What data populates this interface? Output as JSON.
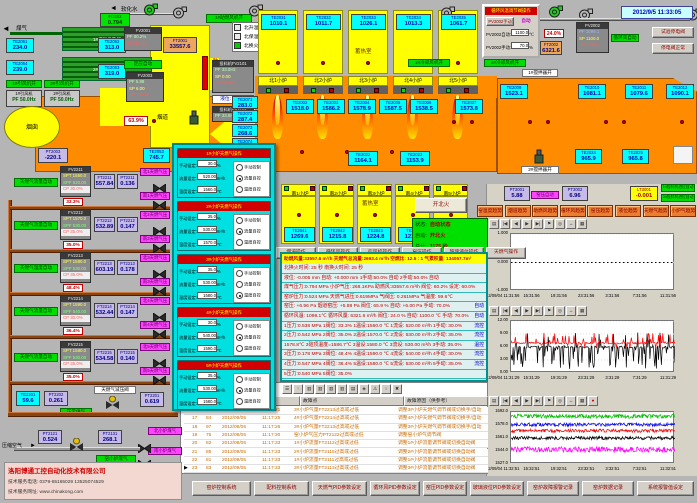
{
  "datetime": "2012/9/5 11:33:05",
  "top_left": {
    "gas_label": "煤气",
    "water_label": "软化水",
    "fi2202": {
      "tag": "FI2202",
      "value": "0.794"
    },
    "hx1": "1#煤气换热器",
    "hx2": "2#煤气换热器",
    "te2061": {
      "tag": "TE2061",
      "value": "234.0"
    },
    "te2062": {
      "tag": "TE2062",
      "value": "313.0"
    },
    "te2063": {
      "tag": "TE2063",
      "value": "319.0"
    },
    "te2064": {
      "tag": "TE2064",
      "value": "239.0"
    },
    "fan1_on": "1#引风机开",
    "fan2_on": "2#引风机开",
    "fan1": {
      "name": "1#引风机",
      "pf": "PF 50.0Hz"
    },
    "fan2": {
      "name": "2#引风机",
      "pf": "PF 50.0Hz"
    },
    "chimney": "烟囱",
    "flue": "烟道",
    "fv2001": {
      "tag": "FV2001",
      "pf": "PF 80.2%",
      "cp": "CP 80.1%"
    },
    "press_auto": "定压自动",
    "fv2003": {
      "tag": "FV2003",
      "pf": "PF 5.88",
      "sp": "SP 6.00",
      "cp": "CP 78.0%"
    },
    "ft2001": {
      "tag": "FT2001",
      "value": "33557.6"
    },
    "pt2003": {
      "tag": "PT2003",
      "value": "-220.1"
    },
    "te2053": {
      "tag": "TE2053",
      "value": "745.7"
    },
    "damper_pos": "63.9%",
    "blower_on": "1#助燃风机开",
    "damper_label": "助燃风开",
    "modes": [
      {
        "label": "北升温",
        "on": false
      },
      {
        "label": "北保温",
        "on": false
      },
      {
        "label": "北换火",
        "on": true
      }
    ],
    "feeder1": {
      "name": "投料机FV2101",
      "pf": "PF 33.0Hz",
      "sp": "SP 0.00",
      "cp": "CP 50.0%"
    },
    "level": "液位: -0.005",
    "feeder2": {
      "name": "投料机FV2102",
      "pf": "PF 33.9Hz"
    }
  },
  "north": {
    "regen": [
      {
        "tag": "TE2031",
        "value": "1010.1"
      },
      {
        "tag": "TE2032",
        "value": "1011.7"
      },
      {
        "tag": "TE2033",
        "value": "1026.1"
      },
      {
        "tag": "TE2034",
        "value": "1013.3"
      },
      {
        "tag": "TE2035",
        "value": "1061.7"
      }
    ],
    "regen_label": "蓄热室",
    "ports": [
      "北1小炉",
      "北2小炉",
      "北3小炉",
      "北4小炉",
      "北5小炉"
    ],
    "cooler1_on": "1#冷却风机开",
    "cooler2_on": "2#冷却风机开",
    "stir1_on": "1#搅拌器开",
    "stir2_on": "2#搅拌器开",
    "crown": [
      {
        "tag": "TE2002",
        "value": "1518.0"
      },
      {
        "tag": "TE2003",
        "value": "1586.2"
      },
      {
        "tag": "TE2004",
        "value": "1578.9"
      },
      {
        "tag": "TE2005",
        "value": "1587.5"
      },
      {
        "tag": "TE2006",
        "value": "1538.5"
      },
      {
        "tag": "TE2007",
        "value": "1573.8"
      }
    ],
    "te2009": {
      "tag": "TE2009",
      "value": "1523.1"
    },
    "side": [
      {
        "tag": "TE2071",
        "value": "283.0"
      },
      {
        "tag": "TE2072",
        "value": "287.4"
      },
      {
        "tag": "TE2073",
        "value": "268.6"
      },
      {
        "tag": "TE2074",
        "value": "269.6"
      }
    ],
    "neck": [
      {
        "tag": "TE2010",
        "value": "1081.1"
      },
      {
        "tag": "TE2011",
        "value": "1079.6"
      },
      {
        "tag": "TE2012",
        "value": "1090.1"
      }
    ],
    "waist": [
      {
        "tag": "TE2022",
        "value": "1164.1"
      },
      {
        "tag": "TE2023",
        "value": "1153.9"
      }
    ],
    "end": [
      {
        "tag": "TE2024",
        "value": "965.9"
      },
      {
        "tag": "TE2025",
        "value": "965.8"
      }
    ]
  },
  "south": {
    "ports": [
      "南1小炉",
      "南2小炉",
      "南3小炉",
      "南4小炉",
      "南5小炉"
    ],
    "regen_label": "蓄热室",
    "temps": [
      {
        "tag": "TE2041",
        "value": "1269.6"
      },
      {
        "tag": "TE2042",
        "value": "1215.8"
      },
      {
        "tag": "TE2043",
        "value": "1224.8"
      },
      {
        "tag": "TE2044",
        "value": "1212.6"
      },
      {
        "tag": "TE2045",
        "value": "1211.8"
      }
    ]
  },
  "fire_btn": "开北火",
  "status_box": {
    "rows": [
      [
        "状态:",
        "自动状态"
      ],
      [
        "自动:",
        "开北火"
      ],
      [
        "总计:",
        "1175 秒"
      ],
      [
        "计时:",
        "269 秒"
      ]
    ]
  },
  "op_buttons": [
    "烟道操作",
    "循环风操作",
    "引风机操作",
    "窑压操作",
    "玻璃液位操作",
    "天燃气操作"
  ],
  "fan_popup": {
    "title": "循环风温调节阀操作",
    "btn_manual": "PV2002手动",
    "mode": "自动",
    "row_auto": {
      "label": "PV2002自动:",
      "value": "1100.0",
      "unit": "℃"
    },
    "row_manual": {
      "label": "PV2002手动:",
      "value": "70.0",
      "unit": "%"
    }
  },
  "pv2002": {
    "tag": "PV2002",
    "pf": "PF 1098.1",
    "sp": "SP 1100.0",
    "cp": "CP 70.0%",
    "auto_label": "循环风自动",
    "pos": "24.0%",
    "ft": {
      "tag": "FT2002",
      "value": "6321.6"
    }
  },
  "tr_buttons": [
    "试验停电阀",
    "停电阀正常"
  ],
  "gas_popup": {
    "sections": [
      {
        "title": "1#小炉天燃气操作",
        "manual": "30.0",
        "flow": "520.00",
        "temp": "1560.0",
        "mode": 1
      },
      {
        "title": "2#小炉天燃气操作",
        "manual": "35.0",
        "flow": "530.00",
        "temp": "1570.0",
        "mode": 1
      },
      {
        "title": "3#小炉天燃气操作",
        "manual": "35.0",
        "flow": "530.00",
        "temp": "1580.0",
        "mode": 2
      },
      {
        "title": "4#小炉天燃气操作",
        "manual": "30.0",
        "flow": "540.00",
        "temp": "1590.0",
        "mode": 1
      },
      {
        "title": "5#小炉天燃气操作",
        "manual": "35.0",
        "flow": "530.00",
        "temp": "1580.0",
        "mode": 1
      }
    ],
    "field_labels": {
      "manual": "手动设定:",
      "flow": "流量设定:",
      "temp": "温度设定:"
    },
    "units": {
      "manual": "%",
      "flow": "m³/h",
      "temp": "℃"
    },
    "radios": [
      "手动控制",
      "流量自控",
      "温度自控"
    ]
  },
  "gas_train": {
    "groups": [
      {
        "auto": "天燃气流量自动",
        "fv": "FV2211",
        "spt": "SPT 1560.0",
        "spf": "SPF 520.00",
        "cp": "CP 30.0%",
        "ft": "FT2211",
        "ftv": "557.84",
        "pt": "PT2211",
        "ptv": "0.136",
        "pos": "33.3%",
        "north": "北1天燃气压",
        "south": "南1天燃气压"
      },
      {
        "auto": "天燃气流量自动",
        "fv": "FV2212",
        "spt": "SPT 1570.0",
        "spf": "SPF 530.00",
        "cp": "CP 35.0%",
        "ft": "FT2212",
        "ftv": "532.89",
        "pt": "PT2212",
        "ptv": "0.147",
        "pos": "35.0%",
        "north": "北2天燃气压",
        "south": "南2天燃气压"
      },
      {
        "auto": "天燃气温度自动",
        "fv": "FV2213",
        "spt": "SPT 1580.0",
        "spf": "SPF 530.00",
        "cp": "CP 35.0%",
        "ft": "FT2213",
        "ftv": "603.19",
        "pt": "PT2213",
        "ptv": "0.178",
        "pos": "48.4%",
        "north": "北3天燃气压",
        "south": "南3天燃气压"
      },
      {
        "auto": "天燃气流量自动",
        "fv": "FV2214",
        "spt": "SPT 1590.0",
        "spf": "SPF 540.00",
        "cp": "CP 30.0%",
        "ft": "FT2214",
        "ftv": "532.44",
        "pt": "PT2214",
        "ptv": "0.147",
        "pos": "36.4%",
        "north": "北4天燃气压",
        "south": "南4天燃气压"
      },
      {
        "auto": "天燃气流量自动",
        "fv": "FV2215",
        "spt": "SPT 1580.0",
        "spf": "SPF 530.00",
        "cp": "CP 35.0%",
        "ft": "FT2215",
        "ftv": "534.58",
        "pt": "PT2215",
        "ptv": "0.140",
        "pos": "35.0%",
        "north": "北5天燃气压",
        "south": "南5天燃气压"
      }
    ],
    "bottom": {
      "te2201": {
        "tag": "TE2201",
        "value": "59.6"
      },
      "pt2202": {
        "tag": "PT2202",
        "value": "0.261"
      },
      "supply": "正常供气",
      "reducer": "天燃气减压阀",
      "pt2201": {
        "tag": "PT2201",
        "value": "0.619"
      },
      "air": "压缩空气",
      "pt2121": {
        "tag": "PT2121",
        "value": "0.524"
      },
      "pt2131": {
        "tag": "PT2131",
        "value": "268.1"
      },
      "coal": "窑小炉煤气",
      "north": "北小炉煤气",
      "south": "南小炉煤气"
    }
  },
  "panel": {
    "head": "助燃风量:33557.6 m³/h  天燃气总流量:2693.4 m³/h  空燃比: 12.5 : 1  气累积量: 134057.7m³",
    "rows": [
      {
        "text": "北换火时间:  25 秒        南换火时间:  25 秒"
      },
      {
        "text": "液位: -0.005 mm  自动: +0.000 mm  1手动:50.0% 自动  2手动:50.0% 自动"
      },
      {
        "text": "煤气压力:0.794 MPa  小炉气压: 268.1KPa  助燃风:33557.6 m³/h 阀位: 60.2% 设定: 60.0%"
      },
      {
        "text": "窑炉压力:0.524 MPa  天燃气进压:0.619MPa  气阀压: 0.261MPa  气温度: 59.6℃"
      },
      {
        "text": "窑压: +6.96 Pa  烟道窑压: +5.88 Pa  阀位: 65.9 %  自动: +6.00 Pa  手动: 70.0%",
        "badge": "自动"
      },
      {
        "text": "循环风温: 1098.1℃  循环风量: 6321.6 m³/h  阀位: 24.0 %  自动: 1100.0 ℃  手动: 70.0%",
        "badge": "自动"
      },
      {
        "text": "1压力:0.538 MPa 1阀位: 33.3%  1温设:1560.0 ℃ 1流设: 520.00 m³/h 1手动: 30.0%",
        "badge": "流控"
      },
      {
        "text": "2压力:0.542 MPa 2阀位: 35.0%  2温设:1570.0 ℃ 2流设: 530.00 m³/h 2手动: 35.0%",
        "badge": "流控"
      },
      {
        "text": "1578.8℃  3碹顶温度=1586.7℃  3温设:1580.0 ℃ 3流设: 530.00 m³/h 3手动: 35.0%",
        "badge": "温控"
      },
      {
        "text": "3压力:0.178 MPa 3阀位: 48.4%  4温设:1590.0 ℃ 4流设: 540.00 m³/h 4手动: 30.0%",
        "badge": "流控"
      },
      {
        "text": "4压力:0.547 MPa 4阀位: 36.4%  5温设:1580.0 ℃ 5流设: 530.00 m³/h 5手动: 35.0%",
        "badge": "流控"
      },
      {
        "text": "5压力:0.540 MPa 5阀位: 35.0%"
      }
    ]
  },
  "right_tags": {
    "pt3001": {
      "tag": "PT3001",
      "value": "5.88"
    },
    "auto": "窑压自动",
    "pt3002": {
      "tag": "PT3002",
      "value": "6.96"
    },
    "lt3001": {
      "tag": "LT3001",
      "value": "-0.001"
    },
    "feed1": "1#投料机进位自动",
    "feed2": "2#投料机进位自动"
  },
  "trend_buttons": [
    "窑温度趋势",
    "烟道趋势",
    "助燃风趋势",
    "循环风趋势",
    "窑压趋势",
    "液位趋势",
    "天燃气趋势",
    "小炉气趋势"
  ],
  "alarm": {
    "col_fault": "故障点",
    "col_reason": "故障原因（供参考）",
    "rows": [
      [
        "16",
        "98",
        "2012/09/05",
        "11:17:21",
        "3#小炉气量FT2213过高或过低",
        "调整3#小炉天燃气调节阀或切换手/自动"
      ],
      [
        "17",
        "84",
        "2012/09/05",
        "11:17:25",
        "4#小炉气量FT2214过高或过低",
        "调整4#小炉天燃气调节阀或切换手/自动"
      ],
      [
        "18",
        "97",
        "2012/09/05",
        "11:17:26",
        "3#小炉气量FT2213过高或过低",
        "调整3#小炉天燃气调节阀或切换手/自动"
      ],
      [
        "19",
        "75",
        "2012/09/05",
        "11:17:30",
        "窑小炉气压力PT2122过高或过低",
        "调整窑小炉气调节阀"
      ],
      [
        "20",
        "82",
        "2012/09/05",
        "11:17:33",
        "1#小炉流量FT2112过高或过低",
        "调整1#小炉流量调节阀或切换自动阀"
      ],
      [
        "21",
        "85",
        "2012/09/05",
        "11:17:33",
        "2#小炉流量FT2115过高或过低",
        "调整2#小炉流量调节阀或切换自动阀"
      ],
      [
        "22",
        "81",
        "2012/09/05",
        "11:17:33",
        "1#小炉流量FT2111过高或过低",
        "调整1#小炉流量调节阀或切换自动阀"
      ],
      [
        "23",
        "83",
        "2012/09/05",
        "11:17:33",
        "3#小炉流量FT2113过高或过低",
        "调整3#小炉流量调节阀或切换自动阀"
      ]
    ]
  },
  "bottom_buttons": [
    "窑炉控制系统",
    "配料控制系统",
    "天燃气PID参数设定",
    "循环风PID参数设定",
    "窑压PID参数设定",
    "玻璃液位PID参数设定",
    "窑炉故障报警记录",
    "窑炉数据记录",
    "系统报警值设定"
  ],
  "company": {
    "name": "洛阳博通工控自动化技术有限公司",
    "phone": "技术服务电话: 0379-65165029  13525074529",
    "web": "技术服务网址: www.chinakong.com"
  },
  "chart_data": [
    {
      "type": "line",
      "title": "窑压趋势",
      "ylim": [
        -1,
        1
      ],
      "yticks": [
        "1.000",
        "0.000",
        "-1.000"
      ],
      "xticks": [
        "12/09/04 11:31:56",
        "15:31:56",
        "19:31:56",
        "23:31:56",
        "3:31:56",
        "7:31:56",
        "11:31:56"
      ],
      "grid": true,
      "series": [
        {
          "name": "窑压",
          "color": "#000000",
          "style": "dotted",
          "base": 0.0,
          "amp": 0.02
        }
      ]
    },
    {
      "type": "line",
      "title": "窑压/烟道压力趋势",
      "ylim": [
        0,
        12
      ],
      "yticks": [
        "12.00",
        "9.00",
        "6.00",
        "3.00",
        "0.00"
      ],
      "xticks": [
        "12/09/04 11:31:29",
        "15:31:29",
        "19:31:29",
        "23:31:29",
        "3:31:29",
        "7:31:29",
        "11:31:29"
      ],
      "grid": false,
      "series": [
        {
          "name": "窑压实测",
          "color": "#000000",
          "style": "spiky",
          "base": 6.0,
          "amp": 5.2
        },
        {
          "name": "烟道压力",
          "color": "#ff0000",
          "style": "spiky-up",
          "base": 6.9,
          "amp": 2.4
        }
      ]
    },
    {
      "type": "line",
      "title": "小炉温度趋势",
      "ylim": [
        1527,
        1595
      ],
      "yticks": [
        "1592.0",
        "1578.0",
        "1561.0",
        "1544.0",
        "1527.0"
      ],
      "xticks": [
        "12/09/04 11:32:51",
        "15:32:51",
        "19:32:51",
        "23:32:51",
        "3:32:51",
        "7:32:51",
        "11:32:51"
      ],
      "grid": false,
      "series": [
        {
          "name": "1#小炉温度",
          "color": "#00bb00",
          "style": "dense",
          "base": 1589.5,
          "amp": 2.6
        },
        {
          "name": "2#小炉温度",
          "color": "#0000ee",
          "style": "dense",
          "base": 1578.5,
          "amp": 2.2
        },
        {
          "name": "3#小炉温度",
          "color": "#ee0000",
          "style": "dense",
          "base": 1570.5,
          "amp": 2.2
        },
        {
          "name": "4#小炉温度",
          "color": "#000000",
          "style": "dense",
          "base": 1561.0,
          "amp": 2.2
        },
        {
          "name": "5#小炉温度",
          "color": "#ff00ff",
          "style": "dense",
          "base": 1546.0,
          "amp": 3.6
        }
      ]
    }
  ]
}
